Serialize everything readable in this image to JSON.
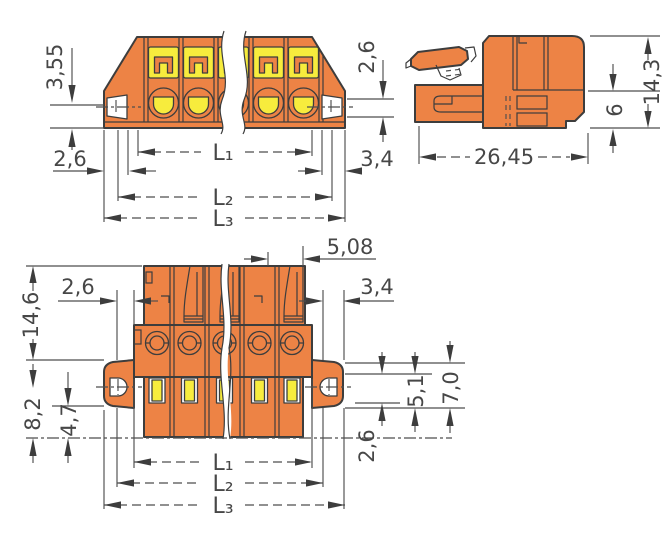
{
  "drawing": {
    "colors": {
      "body_orange": "#ED8345",
      "accent_yellow": "#F7EC3D",
      "outline": "#3D3D3D",
      "dimension": "#4E4E4E",
      "background": "#FFFFFF"
    },
    "views": {
      "front_top": {
        "dims": {
          "d355": "3,55",
          "d26_left": "2,6",
          "d26_right": "2,6",
          "d34_right": "3,4",
          "L1": "L₁",
          "L2": "L₂",
          "L3": "L₃"
        }
      },
      "side": {
        "dims": {
          "d2645": "26,45",
          "d6": "6",
          "d143": "14,3"
        }
      },
      "front_bottom": {
        "dims": {
          "d508": "5,08",
          "d26_top_left": "2,6",
          "d34_right": "3,4",
          "d146": "14,6",
          "d82": "8,2",
          "d47": "4,7",
          "d51": "5,1",
          "d70": "7,0",
          "d26_right": "2,6",
          "L1": "L₁",
          "L2": "L₂",
          "L3": "L₃"
        }
      }
    }
  }
}
